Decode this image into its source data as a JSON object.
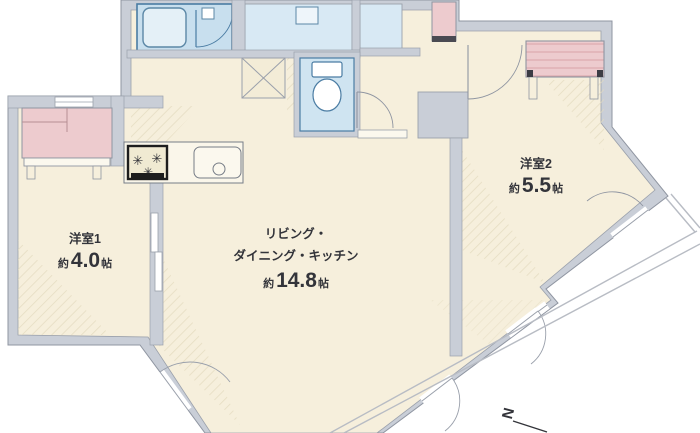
{
  "plan": {
    "title": "floor-plan",
    "rooms": {
      "room1": {
        "name": "洋室1",
        "size_prefix": "約",
        "size_value": "4.0",
        "size_unit": "帖"
      },
      "ldk": {
        "name_line1": "リビング・",
        "name_line2": "ダイニング・キッチン",
        "size_prefix": "約",
        "size_value": "14.8",
        "size_unit": "帖"
      },
      "room2": {
        "name": "洋室2",
        "size_prefix": "約",
        "size_value": "5.5",
        "size_unit": "帖"
      }
    },
    "compass": {
      "label": "N"
    },
    "colors": {
      "floor": "#f6efdc",
      "wall": "#c9ced7",
      "wet_area_blue": "#cfe4f1",
      "washroom_blue": "#d8e9f4",
      "closet_pink": "#edcbce",
      "balcony_line": "#b8bcc4",
      "text": "#33343a"
    }
  }
}
